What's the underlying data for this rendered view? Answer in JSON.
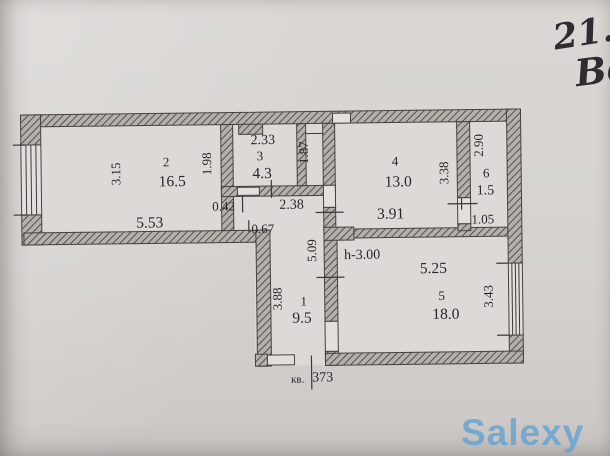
{
  "photo": {
    "handwriting_line1": "21.",
    "handwriting_line2": "Ве",
    "watermark": "Salexy"
  },
  "plan": {
    "rooms": {
      "r1": {
        "num": "1",
        "area": "9.5"
      },
      "r2": {
        "num": "2",
        "area": "16.5"
      },
      "r3": {
        "num": "3",
        "area": "4.3"
      },
      "r4": {
        "num": "4",
        "area": "13.0"
      },
      "r5": {
        "num": "5",
        "area": "18.0"
      },
      "r6": {
        "num": "6",
        "area": "1.5"
      }
    },
    "dims": {
      "d315": "3.15",
      "d553": "5.53",
      "d198": "1.98",
      "d233": "2.33",
      "d187": "1.87",
      "d042": "0.42",
      "d238": "2.38",
      "d067": "0.67",
      "d338": "3.38",
      "d391": "3.91",
      "d290": "2.90",
      "d105": "1.05",
      "d509": "5.09",
      "d525": "5.25",
      "d343": "3.43",
      "d388": "3.88"
    },
    "annotations": {
      "ceiling_height": "h-3.00",
      "apartment_prefix": "кв.",
      "apartment_number": "373"
    },
    "colors": {
      "ink": "#2a282c",
      "paper": "#d6d3d0",
      "watermark_blue": "#60a0d4"
    }
  }
}
